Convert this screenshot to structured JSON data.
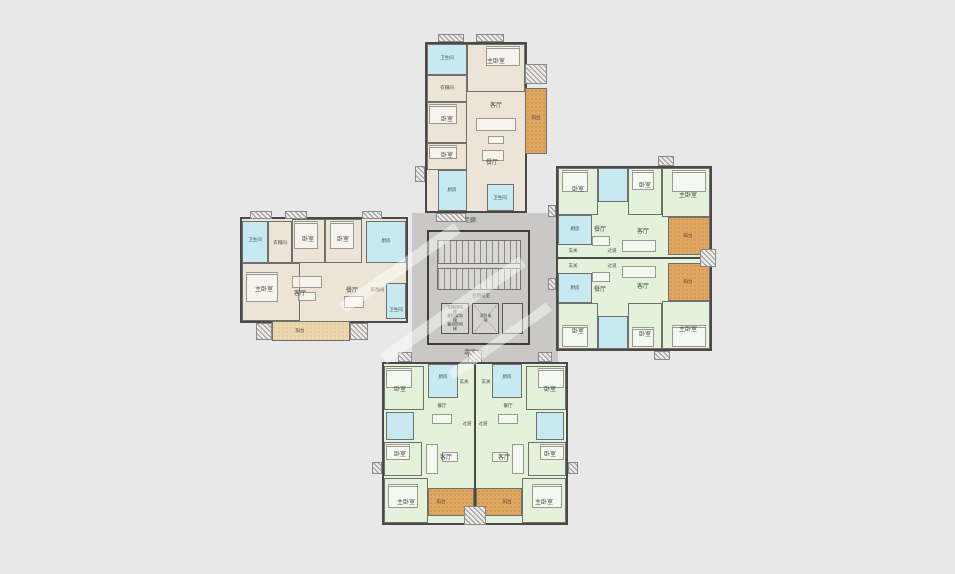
{
  "canvas": {
    "width": 955,
    "height": 574,
    "background": "#e8e8e8"
  },
  "colors": {
    "wall": "#4a4947",
    "room_beige": "#ece5d7",
    "room_green": "#e4f1db",
    "wet_cyan": "#c6e9f2",
    "balcony_orange": "#dfa75f",
    "balcony_light": "#ecd7ae",
    "core_gray": "#c9c8c6",
    "hatch_border": "#8a8987"
  },
  "labels": {
    "master_bedroom": "主卧室",
    "bedroom": "卧室",
    "living_room": "客厅",
    "dining_room": "餐厅",
    "kitchen": "厨房",
    "bathroom": "卫生间",
    "cloakroom": "衣帽间",
    "balcony": "阳台",
    "entry": "玄关",
    "hallway": "过道",
    "utility": "家政间"
  },
  "core": {
    "corridor": "走廊",
    "lobby": "合用前室",
    "elevator_left_lines": [
      "无障碍电梯",
      "兼担架电梯",
      "兼消防电梯"
    ],
    "elevator_right": "消防电梯"
  },
  "units": {
    "north_unit": {
      "fill": "beige",
      "rooms": [
        "主卧室",
        "卧室",
        "卧室",
        "客厅",
        "餐厅",
        "厨房",
        "卫生间",
        "卫生间",
        "衣帽间",
        "阳台"
      ]
    },
    "west_unit": {
      "fill": "beige",
      "rooms": [
        "主卧室",
        "卧室",
        "卧室",
        "客厅",
        "餐厅",
        "厨房",
        "家政间",
        "卫生间",
        "卫生间",
        "衣帽间",
        "阳台"
      ]
    },
    "east_units": {
      "fill": "green",
      "count": 2,
      "rooms": [
        "主卧室",
        "卧室",
        "卧室",
        "客厅",
        "餐厅",
        "厨房",
        "卫生间",
        "玄关",
        "过道",
        "阳台"
      ]
    },
    "south_units": {
      "fill": "green",
      "count": 2,
      "rooms": [
        "主卧室",
        "卧室",
        "卧室",
        "客厅",
        "餐厅",
        "厨房",
        "卫生间",
        "玄关",
        "过道",
        "阳台"
      ]
    }
  }
}
